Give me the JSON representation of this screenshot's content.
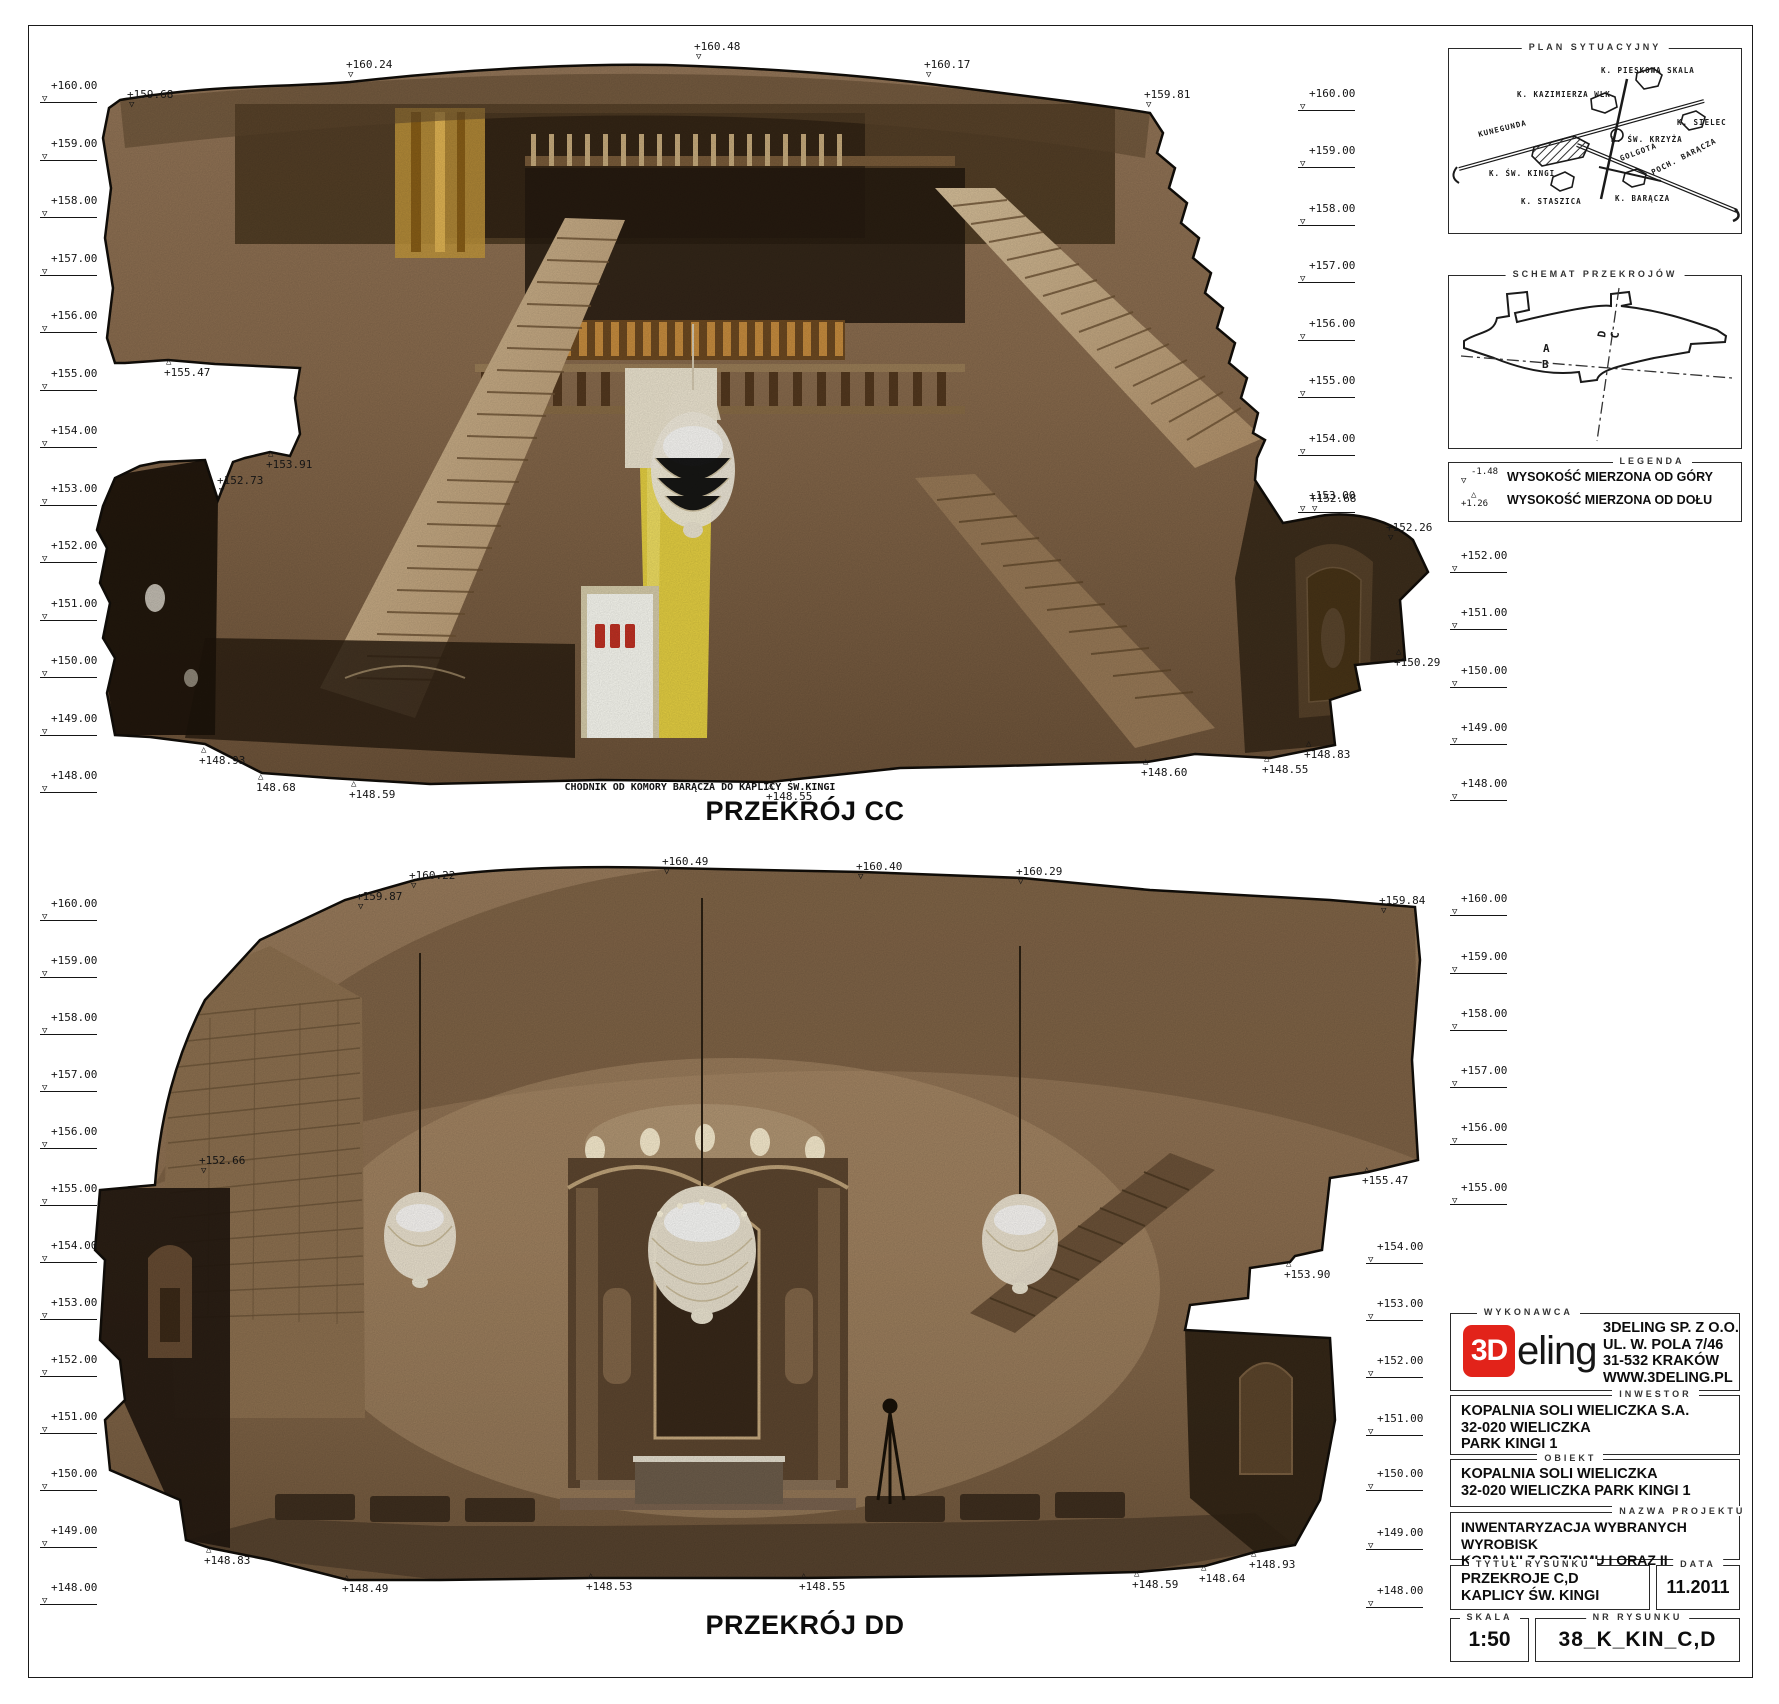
{
  "sheet": {
    "width": 1779,
    "height": 1704
  },
  "cc": {
    "title": "PRZEKRÓJ CC",
    "caption": "CHODNIK OD KOMORY BARĄCZA DO KAPLICY ŚW.KINGI",
    "title_pos": {
      "x": 805,
      "y": 796
    },
    "caption_pos": {
      "x": 700,
      "y": 782
    },
    "levels_left": [
      {
        "label": "+160.00",
        "x": 40,
        "y": 95
      },
      {
        "label": "+159.00",
        "x": 40,
        "y": 153
      },
      {
        "label": "+158.00",
        "x": 40,
        "y": 210
      },
      {
        "label": "+157.00",
        "x": 40,
        "y": 268
      },
      {
        "label": "+156.00",
        "x": 40,
        "y": 325
      },
      {
        "label": "+155.00",
        "x": 40,
        "y": 383
      },
      {
        "label": "+154.00",
        "x": 40,
        "y": 440
      },
      {
        "label": "+153.00",
        "x": 40,
        "y": 498
      },
      {
        "label": "+152.00",
        "x": 40,
        "y": 555
      },
      {
        "label": "+151.00",
        "x": 40,
        "y": 613
      },
      {
        "label": "+150.00",
        "x": 40,
        "y": 670
      },
      {
        "label": "+149.00",
        "x": 40,
        "y": 728
      },
      {
        "label": "+148.00",
        "x": 40,
        "y": 785
      }
    ],
    "levels_right": [
      {
        "label": "+160.00",
        "x": 1298,
        "y": 103
      },
      {
        "label": "+159.00",
        "x": 1298,
        "y": 160
      },
      {
        "label": "+158.00",
        "x": 1298,
        "y": 218
      },
      {
        "label": "+157.00",
        "x": 1298,
        "y": 275
      },
      {
        "label": "+156.00",
        "x": 1298,
        "y": 333
      },
      {
        "label": "+155.00",
        "x": 1298,
        "y": 390
      },
      {
        "label": "+154.00",
        "x": 1298,
        "y": 448
      },
      {
        "label": "+153.00",
        "x": 1298,
        "y": 505
      },
      {
        "label": "+152.00",
        "x": 1450,
        "y": 565
      },
      {
        "label": "+151.00",
        "x": 1450,
        "y": 622
      },
      {
        "label": "+150.00",
        "x": 1450,
        "y": 680
      },
      {
        "label": "+149.00",
        "x": 1450,
        "y": 737
      },
      {
        "label": "+148.00",
        "x": 1450,
        "y": 793
      }
    ],
    "spots": [
      {
        "label": "+159.68",
        "x": 133,
        "y": 112,
        "t": "down"
      },
      {
        "label": "+160.24",
        "x": 352,
        "y": 82,
        "t": "down"
      },
      {
        "label": "+160.48",
        "x": 700,
        "y": 64,
        "t": "down"
      },
      {
        "label": "+160.17",
        "x": 930,
        "y": 82,
        "t": "down"
      },
      {
        "label": "+159.81",
        "x": 1150,
        "y": 112,
        "t": "down"
      },
      {
        "label": "+155.47",
        "x": 170,
        "y": 358,
        "t": "up"
      },
      {
        "label": "+153.91",
        "x": 272,
        "y": 450,
        "t": "up"
      },
      {
        "label": "+152.73",
        "x": 223,
        "y": 498,
        "t": "down"
      },
      {
        "label": "+152.68",
        "x": 1316,
        "y": 516,
        "t": "down"
      },
      {
        "label": "+152.26",
        "x": 1392,
        "y": 545,
        "t": "down"
      },
      {
        "label": "+150.29",
        "x": 1400,
        "y": 648,
        "t": "up"
      },
      {
        "label": "+148.93",
        "x": 205,
        "y": 746,
        "t": "up"
      },
      {
        "label": "148.68",
        "x": 262,
        "y": 773,
        "t": "up"
      },
      {
        "label": "+148.59",
        "x": 355,
        "y": 780,
        "t": "up"
      },
      {
        "label": "+148.55",
        "x": 772,
        "y": 782,
        "t": "up"
      },
      {
        "label": "+148.60",
        "x": 1147,
        "y": 758,
        "t": "up"
      },
      {
        "label": "+148.55",
        "x": 1268,
        "y": 755,
        "t": "up"
      },
      {
        "label": "+148.83",
        "x": 1310,
        "y": 740,
        "t": "up"
      }
    ]
  },
  "dd": {
    "title": "PRZEKRÓJ DD",
    "title_pos": {
      "x": 805,
      "y": 1610
    },
    "levels_left": [
      {
        "label": "+160.00",
        "x": 40,
        "y": 913
      },
      {
        "label": "+159.00",
        "x": 40,
        "y": 970
      },
      {
        "label": "+158.00",
        "x": 40,
        "y": 1027
      },
      {
        "label": "+157.00",
        "x": 40,
        "y": 1084
      },
      {
        "label": "+156.00",
        "x": 40,
        "y": 1141
      },
      {
        "label": "+155.00",
        "x": 40,
        "y": 1198
      },
      {
        "label": "+154.00",
        "x": 40,
        "y": 1255
      },
      {
        "label": "+153.00",
        "x": 40,
        "y": 1312
      },
      {
        "label": "+152.00",
        "x": 40,
        "y": 1369
      },
      {
        "label": "+151.00",
        "x": 40,
        "y": 1426
      },
      {
        "label": "+150.00",
        "x": 40,
        "y": 1483
      },
      {
        "label": "+149.00",
        "x": 40,
        "y": 1540
      },
      {
        "label": "+148.00",
        "x": 40,
        "y": 1597
      }
    ],
    "levels_right": [
      {
        "label": "+160.00",
        "x": 1450,
        "y": 908
      },
      {
        "label": "+159.00",
        "x": 1450,
        "y": 966
      },
      {
        "label": "+158.00",
        "x": 1450,
        "y": 1023
      },
      {
        "label": "+157.00",
        "x": 1450,
        "y": 1080
      },
      {
        "label": "+156.00",
        "x": 1450,
        "y": 1137
      },
      {
        "label": "+155.00",
        "x": 1450,
        "y": 1197
      },
      {
        "label": "+154.00",
        "x": 1366,
        "y": 1256
      },
      {
        "label": "+153.00",
        "x": 1366,
        "y": 1313
      },
      {
        "label": "+152.00",
        "x": 1366,
        "y": 1370
      },
      {
        "label": "+151.00",
        "x": 1366,
        "y": 1428
      },
      {
        "label": "+150.00",
        "x": 1366,
        "y": 1483
      },
      {
        "label": "+149.00",
        "x": 1366,
        "y": 1542
      },
      {
        "label": "+148.00",
        "x": 1366,
        "y": 1600
      }
    ],
    "spots": [
      {
        "label": "+159.87",
        "x": 362,
        "y": 914,
        "t": "down"
      },
      {
        "label": "+160.22",
        "x": 415,
        "y": 893,
        "t": "down"
      },
      {
        "label": "+160.49",
        "x": 668,
        "y": 879,
        "t": "down"
      },
      {
        "label": "+160.40",
        "x": 862,
        "y": 884,
        "t": "down"
      },
      {
        "label": "+160.29",
        "x": 1022,
        "y": 889,
        "t": "down"
      },
      {
        "label": "+159.84",
        "x": 1385,
        "y": 918,
        "t": "down"
      },
      {
        "label": "+155.47",
        "x": 1368,
        "y": 1166,
        "t": "up"
      },
      {
        "label": "+153.90",
        "x": 1290,
        "y": 1260,
        "t": "up"
      },
      {
        "label": "+152.66",
        "x": 205,
        "y": 1178,
        "t": "down"
      },
      {
        "label": "+148.83",
        "x": 210,
        "y": 1546,
        "t": "up"
      },
      {
        "label": "+148.49",
        "x": 348,
        "y": 1574,
        "t": "up"
      },
      {
        "label": "+148.53",
        "x": 592,
        "y": 1572,
        "t": "up"
      },
      {
        "label": "+148.55",
        "x": 805,
        "y": 1572,
        "t": "up"
      },
      {
        "label": "+148.59",
        "x": 1138,
        "y": 1570,
        "t": "up"
      },
      {
        "label": "+148.64",
        "x": 1205,
        "y": 1564,
        "t": "up"
      },
      {
        "label": "+148.93",
        "x": 1255,
        "y": 1550,
        "t": "up"
      }
    ]
  },
  "plan_box": {
    "header": "PLAN SYTUACYJNY",
    "labels": [
      {
        "t": "K. PIESKOWA SKALA",
        "x": 152,
        "y": 24,
        "r": 0
      },
      {
        "t": "K. KAZIMIERZA WLK.",
        "x": 68,
        "y": 48,
        "r": 0
      },
      {
        "t": "K. SIELEC",
        "x": 228,
        "y": 76,
        "r": 0
      },
      {
        "t": "KUNEGUNDA",
        "x": 30,
        "y": 88,
        "r": -14
      },
      {
        "t": "K. ŚW. KRZYŻA",
        "x": 162,
        "y": 93,
        "r": 0
      },
      {
        "t": "GOLGOTA",
        "x": 172,
        "y": 112,
        "r": -20
      },
      {
        "t": "K. ŚW. KINGI",
        "x": 40,
        "y": 127,
        "r": 0
      },
      {
        "t": "POCH. BARĄCZA",
        "x": 204,
        "y": 126,
        "r": -27
      },
      {
        "t": "K. STASZICA",
        "x": 72,
        "y": 155,
        "r": 0
      },
      {
        "t": "K. BARĄCZA",
        "x": 166,
        "y": 152,
        "r": 0
      }
    ]
  },
  "schemat_box": {
    "header": "SCHEMAT PRZEKROJÓW",
    "labels": [
      {
        "t": "A",
        "x": 94,
        "y": 76,
        "r": 0
      },
      {
        "t": "B",
        "x": 93,
        "y": 92,
        "r": 0
      },
      {
        "t": "D",
        "x": 156,
        "y": 62,
        "r": -80
      },
      {
        "t": "C",
        "x": 169,
        "y": 63,
        "r": -80
      }
    ]
  },
  "legend": {
    "header": "LEGENDA",
    "items": [
      {
        "above": "-1.48",
        "below": "▽",
        "text": "WYSOKOŚĆ MIERZONA OD GÓRY"
      },
      {
        "above": "△",
        "below": "+1.26",
        "text": "WYSOKOŚĆ MIERZONA OD DOŁU"
      }
    ]
  },
  "titleblock": {
    "wykonawca": {
      "header": "WYKONAWCA",
      "logo_3d": "3D",
      "logo_rest": "eling",
      "lines": [
        "3DELING SP. Z O.O.",
        "UL. W. POLA 7/46",
        "31-532 KRAKÓW",
        "WWW.3DELING.PL"
      ]
    },
    "inwestor": {
      "header": "INWESTOR",
      "lines": [
        "KOPALNIA SOLI WIELICZKA S.A.",
        "32-020 WIELICZKA",
        "PARK KINGI 1"
      ]
    },
    "obiekt": {
      "header": "OBIEKT",
      "lines": [
        "KOPALNIA SOLI WIELICZKA",
        "32-020 WIELICZKA PARK KINGI 1"
      ]
    },
    "nazwa_projektu": {
      "header": "NAZWA PROJEKTU",
      "lines": [
        "INWENTARYZACJA WYBRANYCH WYROBISK",
        "KOPALNI Z POZIOMU I ORAZ II"
      ]
    },
    "tytul_rysunku": {
      "header": "TYTUŁ RYSUNKU",
      "lines": [
        "PRZEKROJE C,D",
        "KAPLICY ŚW. KINGI"
      ]
    },
    "data": {
      "header": "DATA",
      "value": "11.2011"
    },
    "skala": {
      "header": "SKALA",
      "value": "1:50"
    },
    "nr_rysunku": {
      "header": "NR RYSUNKU",
      "value": "38_K_KIN_C,D"
    }
  },
  "colors": {
    "logo_red": "#e2231a",
    "line": "#1a1a1a",
    "rock_base": "#8c6f50",
    "rock_dark": "#3a2b1c",
    "yellow_drape": "#e8d243",
    "crystal": "#f2ead8"
  }
}
